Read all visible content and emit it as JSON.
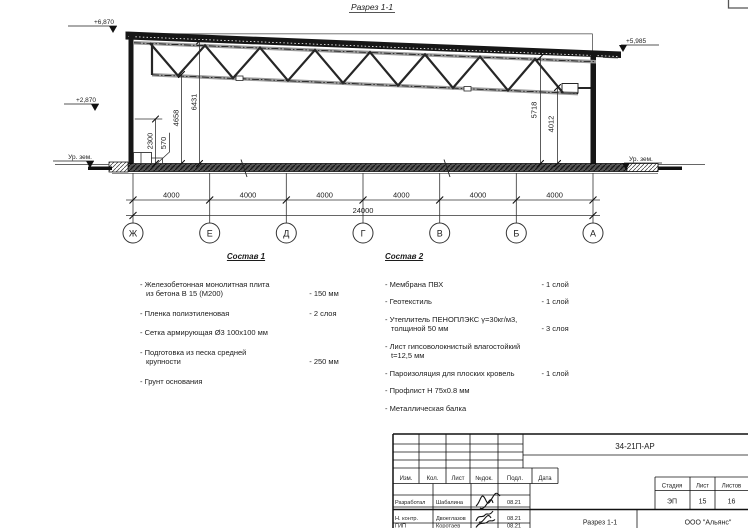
{
  "drawing": {
    "title": "Разрез 1-1",
    "elev_top_left": "+6,870",
    "elev_mid_left": "+2,870",
    "elev_top_right": "+5,985",
    "ground_left": "Ур. зем.",
    "ground_right": "Ур. зем.",
    "dim_2300": "2300",
    "dim_570": "570",
    "dim_4658": "4658",
    "dim_6431": "6431",
    "dim_5718": "5718",
    "dim_4012": "4012",
    "span": "4000",
    "total": "24000",
    "axes": [
      "Ж",
      "Е",
      "Д",
      "Г",
      "В",
      "Б",
      "А"
    ]
  },
  "sostav1": {
    "title": "Состав 1",
    "items": [
      {
        "text": "- Железобетонная  монолитная плита\nиз бетона В 15 (М200)",
        "value": "- 150 мм"
      },
      {
        "text": "- Пленка полиэтиленовая",
        "value": "- 2 слоя"
      },
      {
        "text": "- Сетка армирующая Ø3 100х100 мм",
        "value": ""
      },
      {
        "text": "- Подготовка из песка средней\nкрупности",
        "value": "- 250 мм"
      },
      {
        "text": "- Грунт основания",
        "value": ""
      }
    ]
  },
  "sostav2": {
    "title": "Состав 2",
    "items": [
      {
        "text": "- Мембрана ПВХ",
        "value": "- 1 слой"
      },
      {
        "text": "- Геотекстиль",
        "value": "- 1 слой"
      },
      {
        "text": "- Утеплитель ПЕНОПЛЭКС γ=30кг/м3,\nтолщиной 50 мм",
        "value": "- 3 слоя"
      },
      {
        "text": "- Лист гипсоволокнистый влагостойкий\nt=12,5 мм",
        "value": ""
      },
      {
        "text": "- Пароизоляция для плоских кровель",
        "value": "- 1 слой"
      },
      {
        "text": "- Профлист Н 75х0.8 мм",
        "value": ""
      },
      {
        "text": "- Металлическая балка",
        "value": ""
      }
    ]
  },
  "titleblock": {
    "doc_code": "34-21П-АР",
    "rev_cols": [
      "Изм.",
      "Кол.",
      "Лист",
      "№док.",
      "Подл.",
      "Дата"
    ],
    "sign_rows": [
      {
        "role": "Разработал",
        "name": "Шабалина",
        "date": "08.21"
      },
      {
        "role": "Н. контр.",
        "name": "Двоеглазов",
        "date": "08.21"
      },
      {
        "role": "ГИП",
        "name": "Коротаев",
        "date": "08.21"
      }
    ],
    "stage_label": "Стадия",
    "sheet_label": "Лист",
    "sheets_label": "Листов",
    "stage": "ЭП",
    "sheet": "15",
    "sheets": "16",
    "section_name": "Разрез 1-1",
    "company": "ООО \"Альянс\""
  }
}
